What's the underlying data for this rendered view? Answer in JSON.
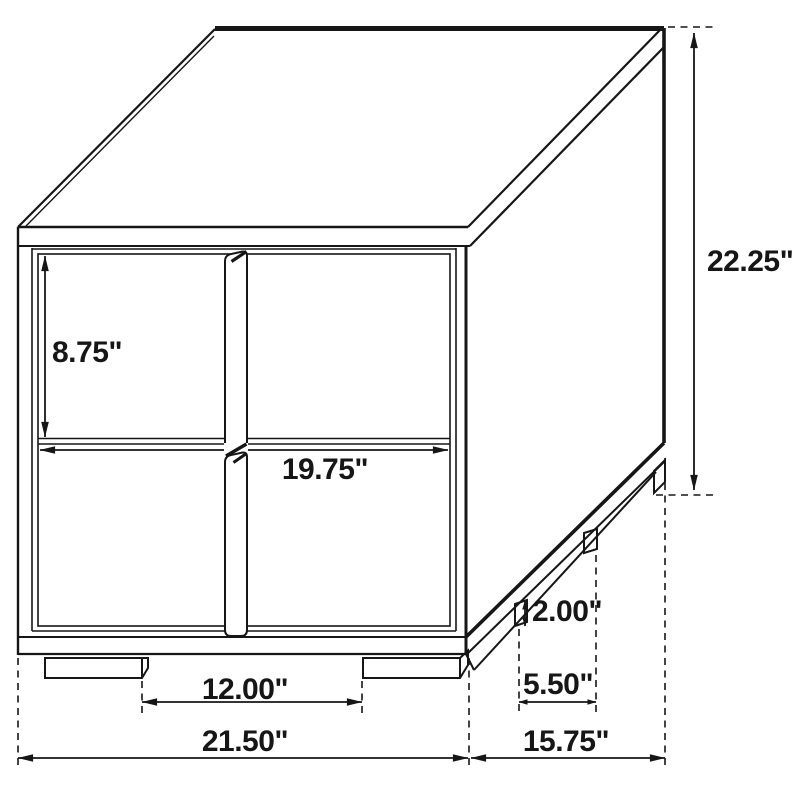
{
  "diagram": {
    "type": "furniture-dimension-drawing",
    "subject": "Two-drawer nightstand, isometric line drawing with dimensions",
    "unit": "inches",
    "line_color": "#161616",
    "background_color": "#ffffff"
  },
  "labels": {
    "drawer_height": "8.75\"",
    "overall_height": "22.25\"",
    "opening_width": "19.75\"",
    "base_height": "2.00\"",
    "front_leg_spacing": "12.00\"",
    "side_leg_spacing": "5.50\"",
    "overall_width": "21.50\"",
    "overall_depth": "15.75\""
  }
}
